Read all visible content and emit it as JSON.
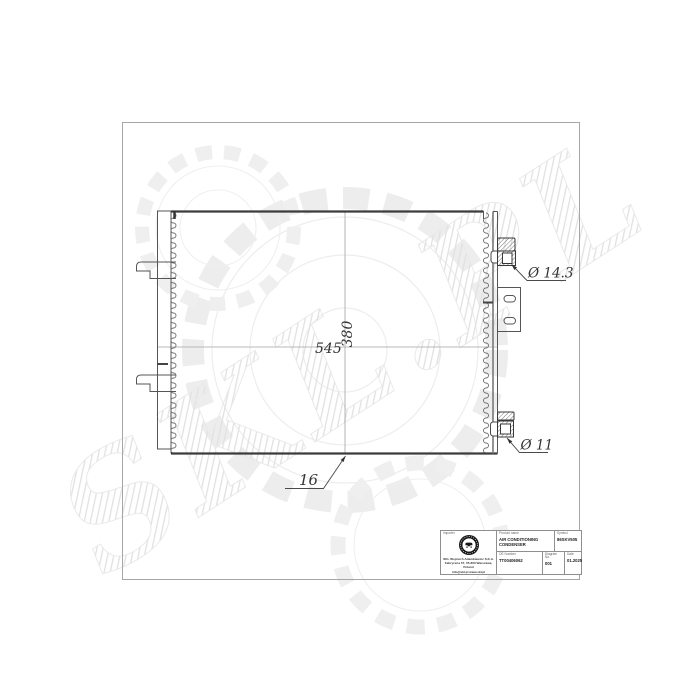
{
  "watermark": {
    "text": "SKL.PL"
  },
  "dimensions": {
    "core_width": "545",
    "core_height": "380",
    "core_depth": "16",
    "inlet_diameter": "Ø 14.3",
    "outlet_diameter": "Ø 11"
  },
  "title_block": {
    "importer_label": "Importer",
    "company_lines": [
      "SKL Wojciech Adamkiewicz S.K.A.",
      "Fabryczna 57, 05-800 Warszawa, Poland",
      "info@skl.pl  www.skl.pl"
    ],
    "product_name_label": "Product name",
    "product_name": "AIR CONDITIONING CONDENSER",
    "symbol_label": "Symbol",
    "symbol": "86SKV505",
    "oe_number_label": "OE Number",
    "oe_number": "TT00406062",
    "diagram_no_label": "Diagram No.",
    "diagram_no": "001",
    "date_label": "Date",
    "date": "01.2025"
  }
}
